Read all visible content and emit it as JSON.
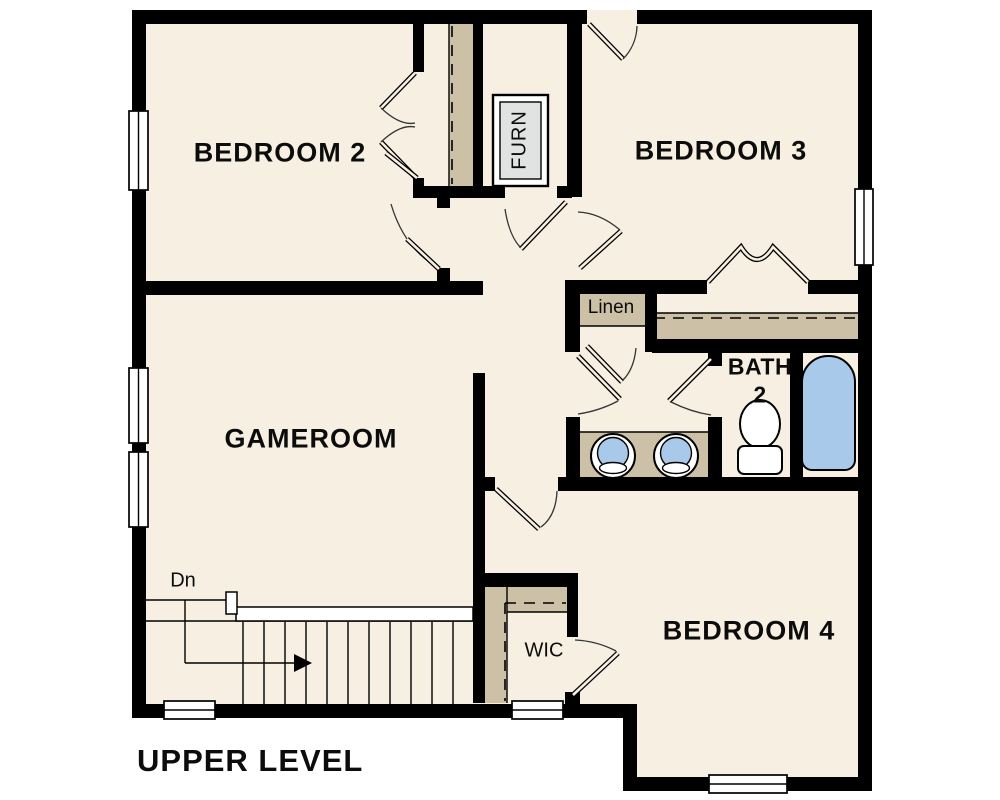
{
  "plan_title": "UPPER LEVEL",
  "labels": {
    "bedroom2": "BEDROOM 2",
    "bedroom3": "BEDROOM 3",
    "gameroom": "GAMEROOM",
    "bedroom4": "BEDROOM 4",
    "bath_name": "BATH",
    "bath_number": "2",
    "linen": "Linen",
    "wic": "WIC",
    "furnace": "FURN",
    "stairs_down": "Dn"
  },
  "colors": {
    "floor": "#f6efe2",
    "wall": "#000000",
    "closet_shelf": "#ccc0a6",
    "fixture_blue": "#a9c9ea",
    "furnace_gray": "#e0e3e2",
    "background": "#ffffff"
  }
}
